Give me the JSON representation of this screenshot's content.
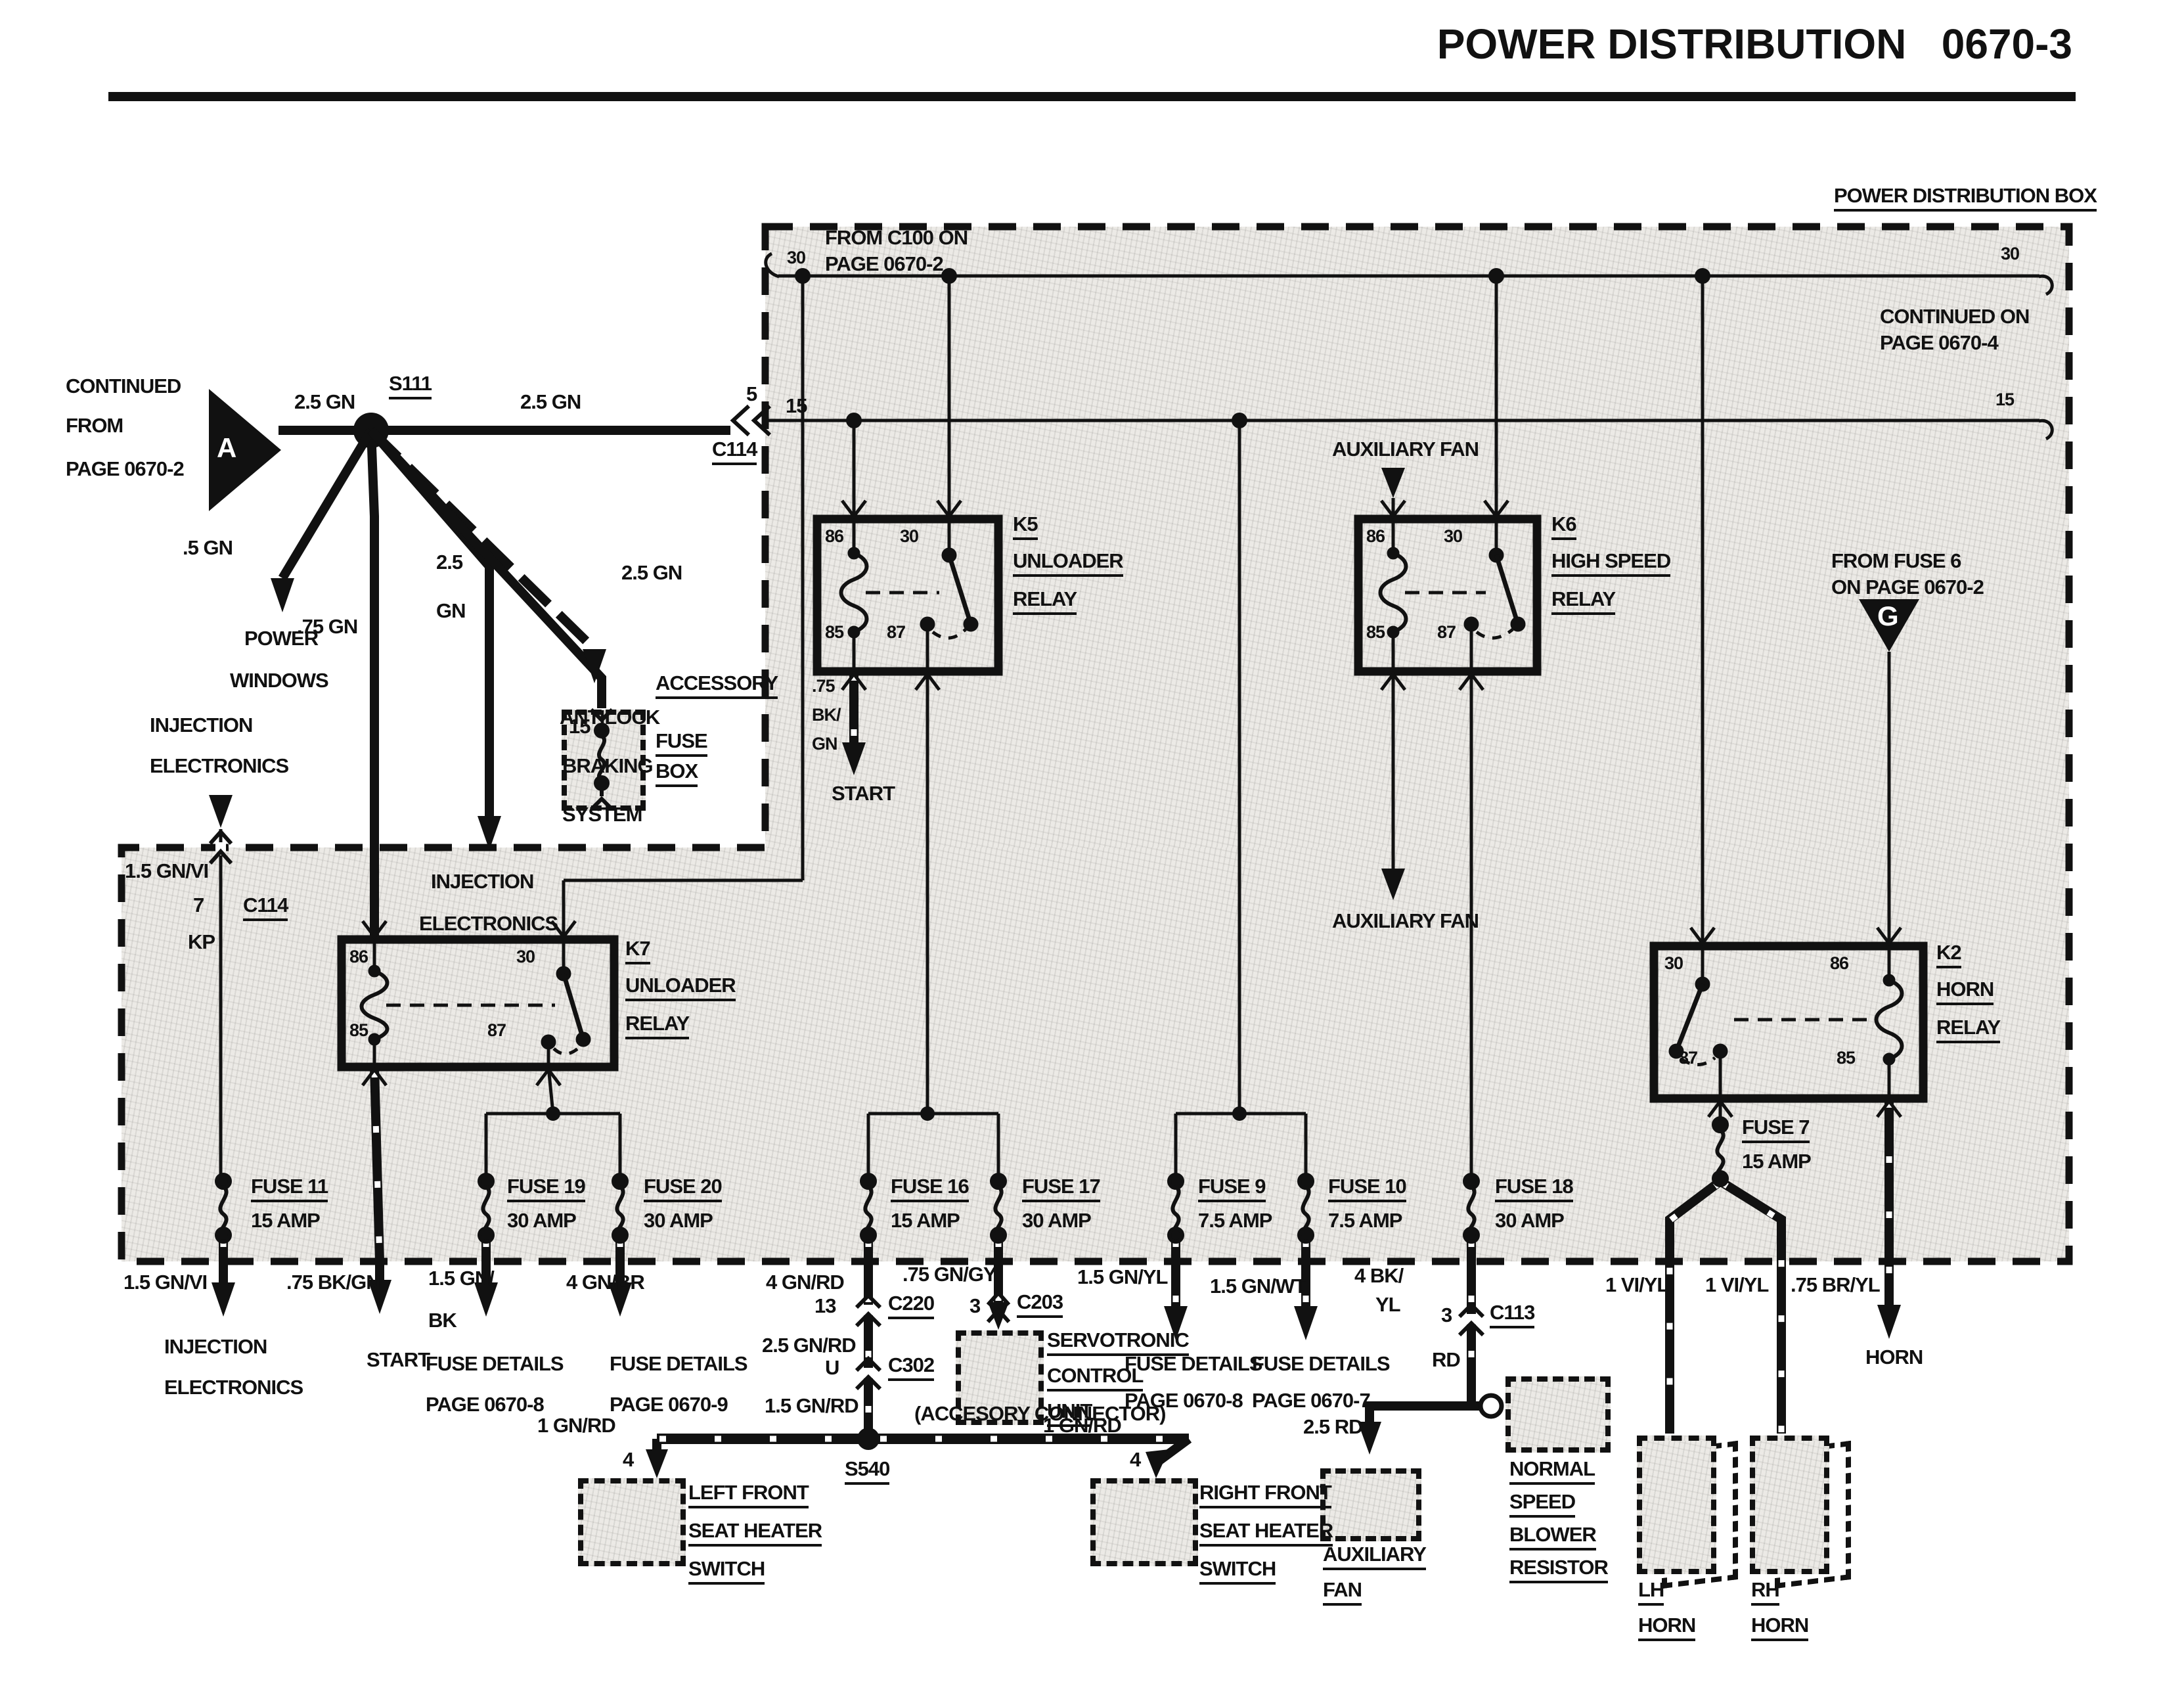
{
  "colors": {
    "ink": "#111111",
    "paper": "#ffffff",
    "box_fill": "#eceae6"
  },
  "header": {
    "title": "POWER DISTRIBUTION   0670-3",
    "box_label": "POWER DISTRIBUTION BOX"
  },
  "entry": {
    "l1": "CONTINUED",
    "l2": "FROM",
    "l3": "PAGE 0670-2",
    "marker": "A",
    "wire_a": "2.5 GN",
    "splice": "S111",
    "wire_b": "2.5 GN",
    "pin": "5",
    "conn": "C114",
    "bus_pin": "15"
  },
  "branches": {
    "power_wire": ".5 GN",
    "power1": "POWER",
    "power2": "WINDOWS",
    "mid_wire": ".75 GN",
    "inj_w1": "2.5",
    "inj_w2": "GN",
    "inj1": "INJECTION",
    "inj2": "ELECTRONICS",
    "abs_wire": "2.5 GN",
    "abs1": "ANTILOCK",
    "abs2": "BRAKING",
    "abs3": "SYSTEM"
  },
  "acc_fuse_box": {
    "pin": "15",
    "l1": "ACCESSORY",
    "l2": "FUSE",
    "l3": "BOX"
  },
  "inj_src": {
    "l1": "INJECTION",
    "l2": "ELECTRONICS",
    "wire": "1.5 GN/VI",
    "pin": "7",
    "conn": "C114",
    "term": "KP"
  },
  "bus30": {
    "left": "30",
    "right": "30",
    "src1": "FROM C100 ON",
    "src2": "PAGE 0670-2"
  },
  "bus15": {
    "left": "15",
    "right": "15",
    "cont1": "CONTINUED ON",
    "cont2": "PAGE 0670-4"
  },
  "k5": {
    "name": "K5",
    "t1": "UNLOADER",
    "t2": "RELAY",
    "p86": "86",
    "p30": "30",
    "p85": "85",
    "p87": "87",
    "out1": ".75",
    "out2": "BK/",
    "out3": "GN",
    "dest": "START"
  },
  "k6": {
    "name": "K6",
    "t1": "HIGH SPEED",
    "t2": "RELAY",
    "p86": "86",
    "p30": "30",
    "p85": "85",
    "p87": "87",
    "src": "AUXILIARY FAN",
    "dest": "AUXILIARY FAN"
  },
  "k7": {
    "name": "K7",
    "t1": "UNLOADER",
    "t2": "RELAY",
    "p86": "86",
    "p30": "30",
    "p85": "85",
    "p87": "87"
  },
  "k2": {
    "name": "K2",
    "t1": "HORN",
    "t2": "RELAY",
    "p30": "30",
    "p86": "86",
    "p87": "87",
    "p85": "85"
  },
  "g_src": {
    "l1": "FROM FUSE 6",
    "l2": "ON PAGE 0670-2",
    "marker": "G"
  },
  "fuses": {
    "f11": {
      "n": "FUSE 11",
      "a": "15 AMP"
    },
    "f19": {
      "n": "FUSE 19",
      "a": "30 AMP"
    },
    "f20": {
      "n": "FUSE 20",
      "a": "30 AMP"
    },
    "f16": {
      "n": "FUSE 16",
      "a": "15 AMP"
    },
    "f17": {
      "n": "FUSE 17",
      "a": "30 AMP"
    },
    "f9": {
      "n": "FUSE 9",
      "a": "7.5 AMP"
    },
    "f10": {
      "n": "FUSE 10",
      "a": "7.5 AMP"
    },
    "f18": {
      "n": "FUSE 18",
      "a": "30 AMP"
    },
    "f7": {
      "n": "FUSE 7",
      "a": "15 AMP"
    }
  },
  "out": {
    "inj": {
      "wire": "1.5 GN/VI",
      "d1": "INJECTION",
      "d2": "ELECTRONICS"
    },
    "start": {
      "wire": ".75 BK/GN",
      "dest": "START"
    },
    "f19": {
      "w1": "1.5 GN/",
      "w2": "BK",
      "d1": "FUSE DETAILS",
      "d2": "PAGE 0670-8"
    },
    "f20": {
      "wire": "4 GN/BR",
      "d1": "FUSE DETAILS",
      "d2": "PAGE 0670-9"
    },
    "f16": {
      "wire": "4 GN/RD",
      "pin13": "13",
      "c220": "C220",
      "wire2": "2.5 GN/RD",
      "pinU": "U",
      "c302": "C302",
      "wire3": "1.5 GN/RD"
    },
    "acc": {
      "note": "(ACCESORY CONNECTOR)",
      "splice": "S540",
      "lwire": "1 GN/RD",
      "lpin": "4",
      "rwire": "1 GN/RD",
      "rpin": "4",
      "lh1": "LEFT FRONT",
      "lh2": "SEAT HEATER",
      "lh3": "SWITCH",
      "rh1": "RIGHT FRONT",
      "rh2": "SEAT HEATER",
      "rh3": "SWITCH"
    },
    "f17": {
      "wire": ".75 GN/GY",
      "pin": "3",
      "conn": "C203",
      "s1": "SERVOTRONIC",
      "s2": "CONTROL",
      "s3": "UNIT"
    },
    "f9": {
      "wire": "1.5 GN/YL",
      "d1": "FUSE DETAILS",
      "d2": "PAGE 0670-8"
    },
    "f10": {
      "wire": "1.5 GN/WT",
      "d1": "FUSE DETAILS",
      "d2": "PAGE 0670-7"
    },
    "f18": {
      "w1": "4 BK/",
      "w2": "YL",
      "pin": "3",
      "conn": "C113",
      "rd": "RD",
      "rd2": "2.5 RD",
      "a1": "AUXILIARY",
      "a2": "FAN",
      "b1": "NORMAL",
      "b2": "SPEED",
      "b3": "BLOWER",
      "b4": "RESISTOR"
    },
    "horns": {
      "lwire": "1 VI/YL",
      "rwire": "1 VI/YL",
      "hwire": ".75 BR/YL",
      "horn": "HORN",
      "lh1": "LH",
      "lh2": "HORN",
      "rh1": "RH",
      "rh2": "HORN"
    }
  }
}
